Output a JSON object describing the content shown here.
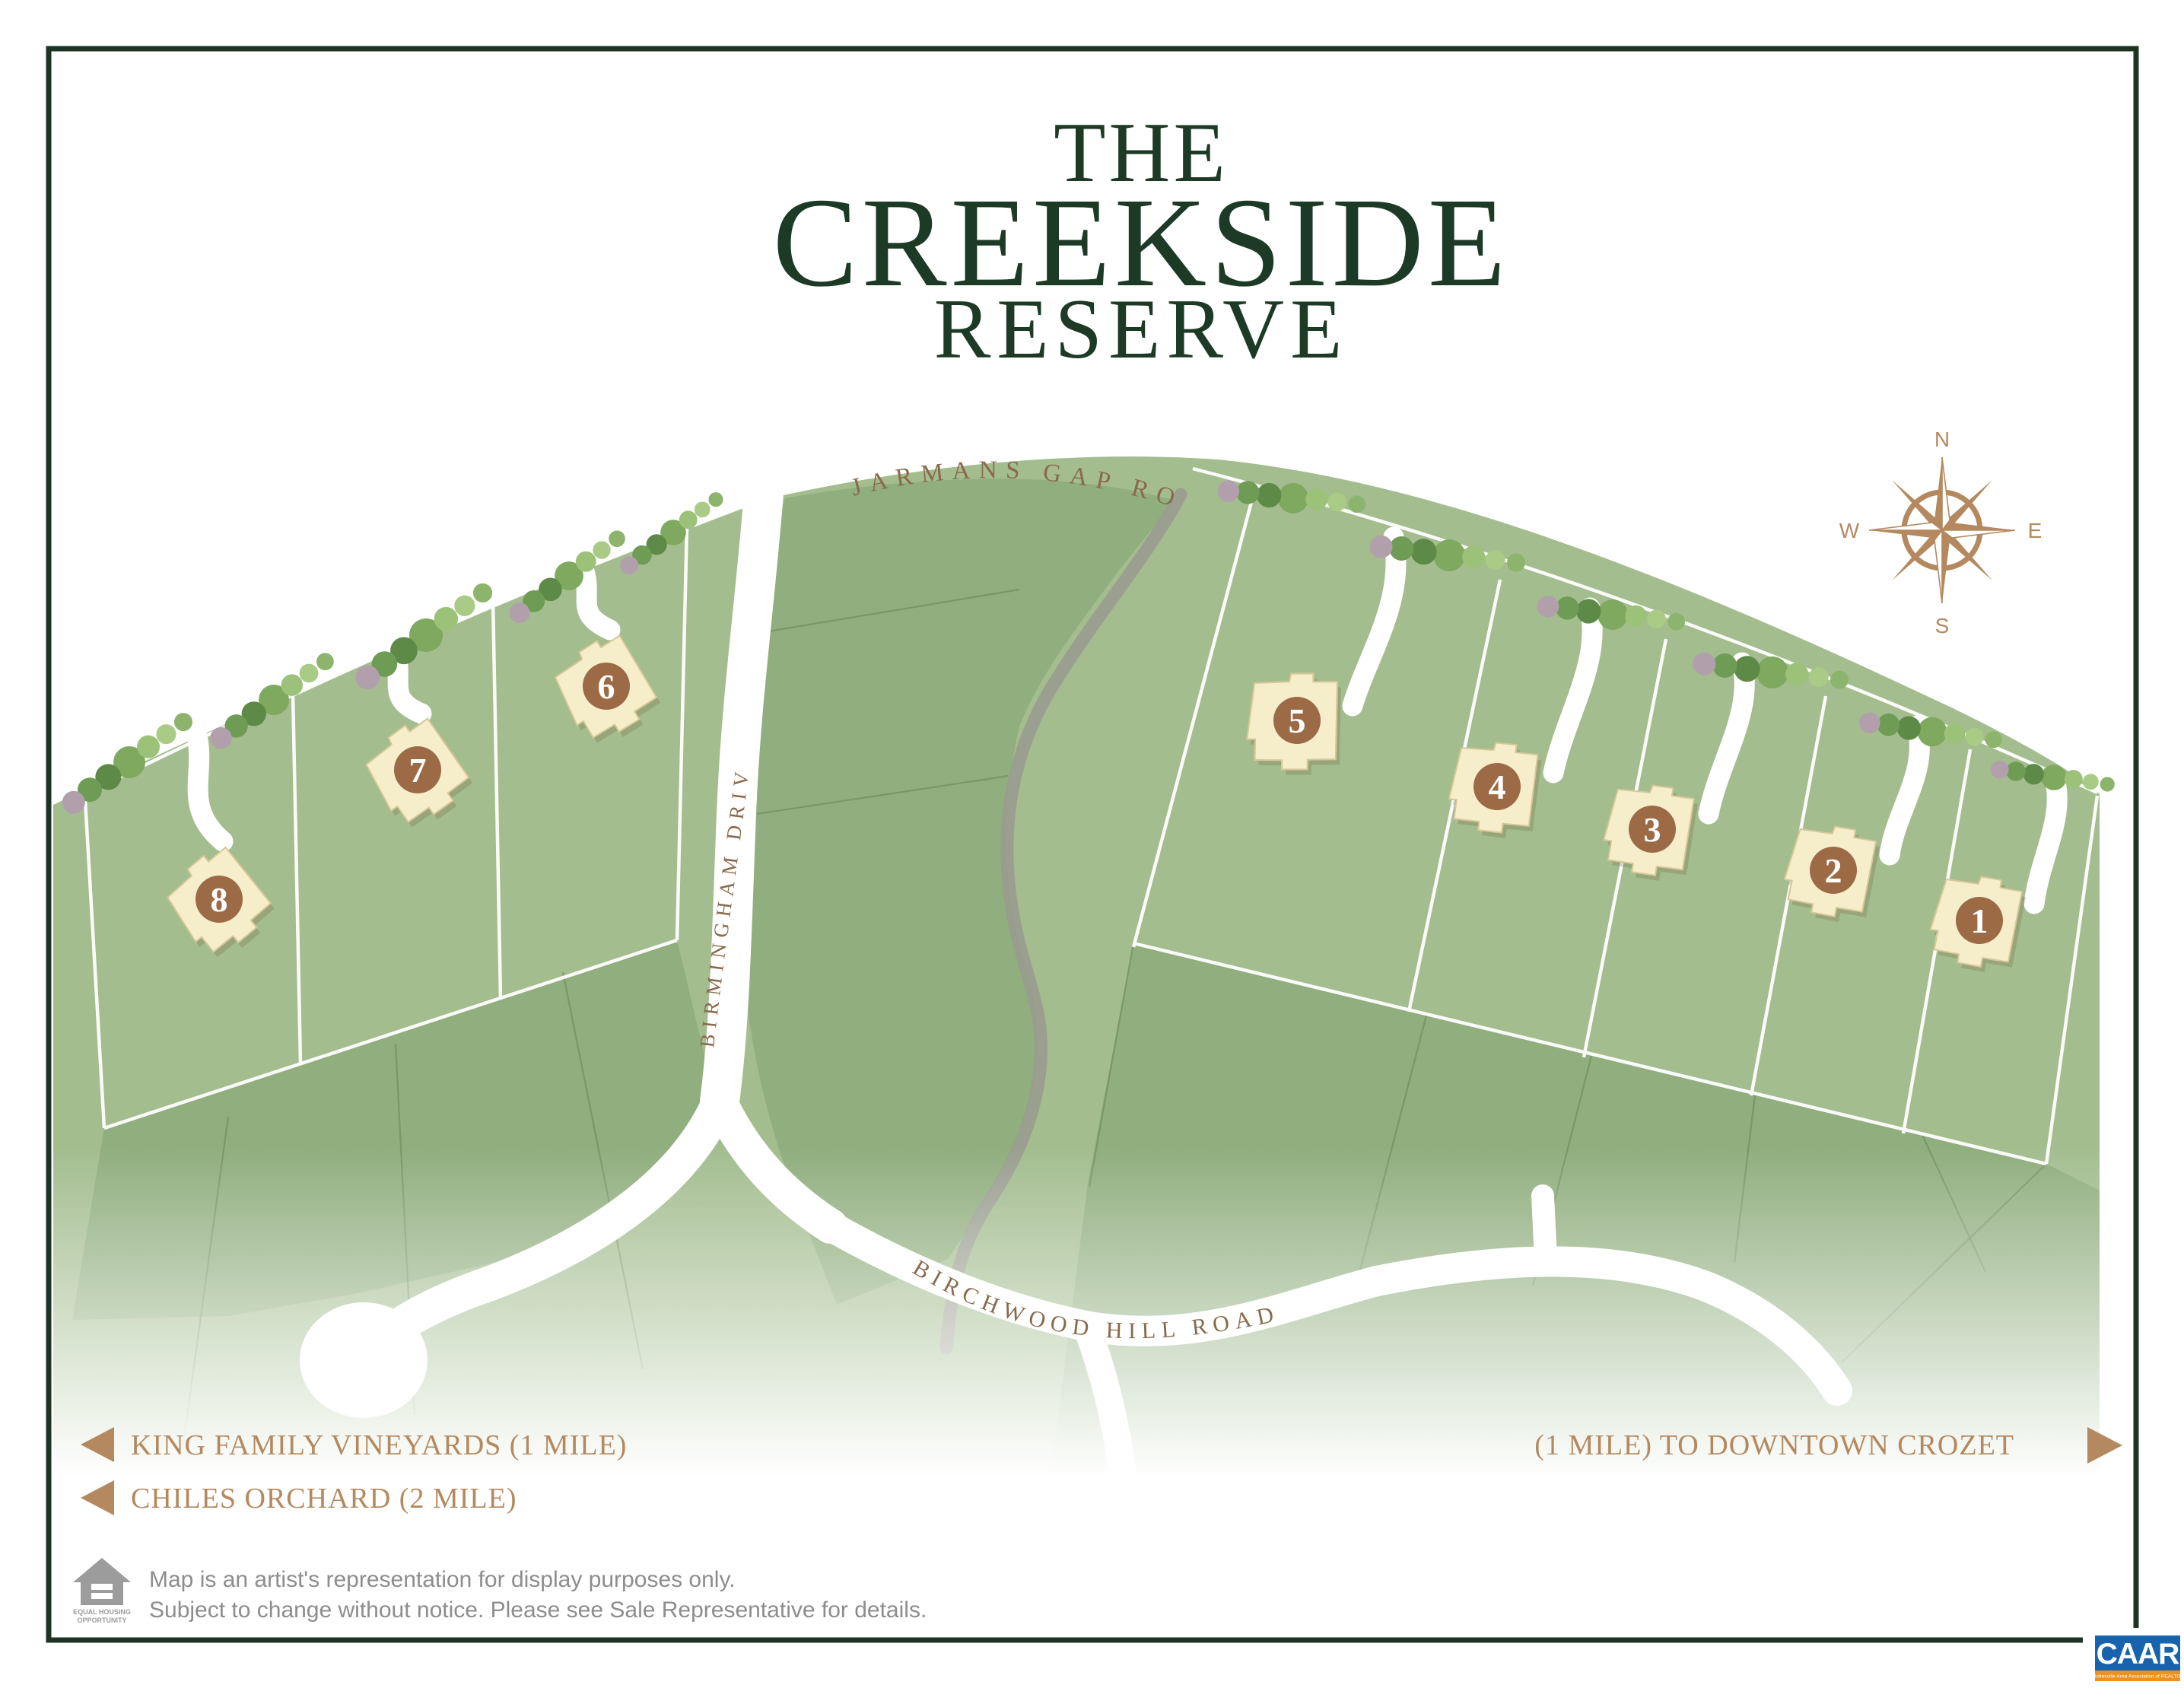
{
  "title": {
    "line1": "THE",
    "line2": "CREEKSIDE",
    "line3": "RESERVE"
  },
  "roads": {
    "jarmans_gap": "JARMANS GAP ROAD",
    "birmingham": "BIRMINGHAM DRIVE",
    "birchwood_hill": "BIRCHWOOD HILL ROAD"
  },
  "compass": {
    "north": "N",
    "east": "E",
    "south": "S",
    "west": "W"
  },
  "lots": [
    {
      "number": "1"
    },
    {
      "number": "2"
    },
    {
      "number": "3"
    },
    {
      "number": "4"
    },
    {
      "number": "5"
    },
    {
      "number": "6"
    },
    {
      "number": "7"
    },
    {
      "number": "8"
    }
  ],
  "directions": {
    "left": [
      {
        "label": "KING FAMILY VINEYARDS (1 MILE)"
      },
      {
        "label": "CHILES ORCHARD (2 MILE)"
      }
    ],
    "right": {
      "label": "(1 MILE) TO DOWNTOWN CROZET"
    }
  },
  "disclaimer": {
    "line1": "Map is an artist's representation for display purposes only.",
    "line2": "Subject to change without notice. Please see Sale Representative for details."
  },
  "equal_housing": {
    "line1": "EQUAL HOUSING",
    "line2": "OPPORTUNITY"
  },
  "caar": {
    "name": "CAAR",
    "tagline": "Charlottesville Area Association of REALTORS®"
  },
  "colors": {
    "title_green": "#1c3a26",
    "label_brown": "#8a6a4c",
    "accent_tan": "#b4895f",
    "badge_brown": "#9c6b46",
    "frame_green": "#1d3425",
    "disclaimer_gray": "#8d8d8d",
    "caar_blue": "#1763ad",
    "caar_orange": "#ec9120",
    "land_green": "#a3bd8f",
    "land_dark": "#90ae7e",
    "road_white": "#ffffff",
    "creek_gray": "#9a9b90"
  }
}
